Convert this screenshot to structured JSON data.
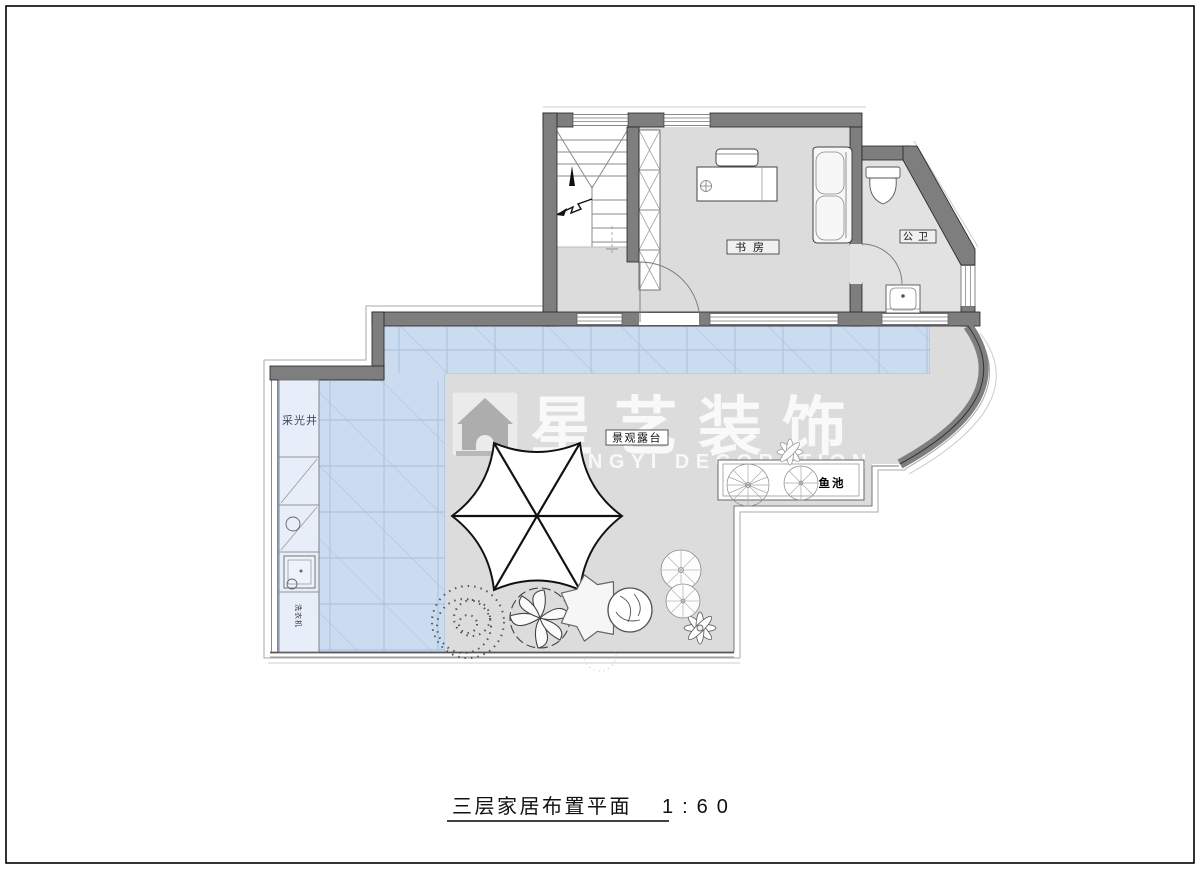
{
  "title": {
    "text": "三层家居布置平面",
    "scale": "1:60"
  },
  "watermark": {
    "brand": "星艺装饰",
    "subtitle": "XINGYI DECORATION"
  },
  "labels": {
    "study": "书房",
    "bathroom": "公卫",
    "terrace": "景观露台",
    "light_well": "采光井",
    "fish_pond": "鱼池",
    "washing_machine": "洗衣机"
  },
  "colors": {
    "wall": "#7e7e7e",
    "wall_edge": "#222222",
    "glass": "#cbdcf0",
    "glass_grid": "#a6bddb",
    "glass_hatch": "#b9cce6",
    "floor_gray": "#dcdcdc",
    "bath_floor": "#e2e2e2",
    "outline_light": "#aaaaaa",
    "watermark_white": "rgba(255,255,255,0.93)"
  }
}
